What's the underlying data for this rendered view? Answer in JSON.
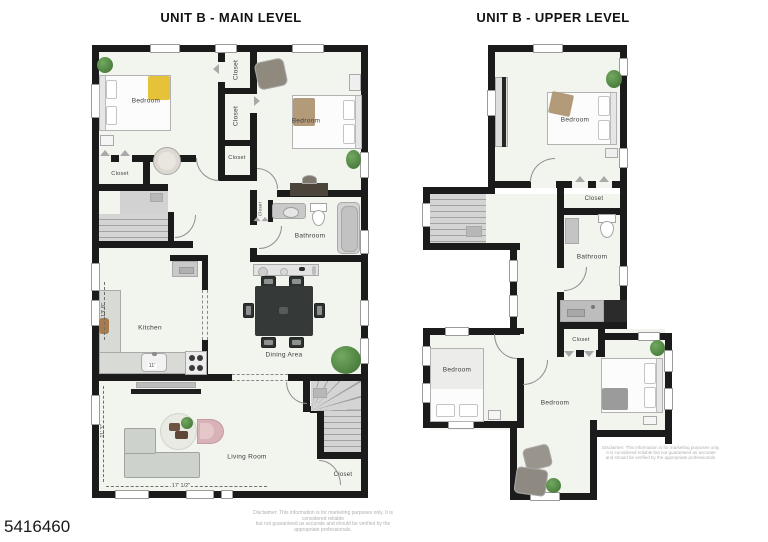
{
  "photo_id": "5416460",
  "disclaimer": {
    "line1": "Disclaimer: This information is for marketing purposes only. It is considered reliable",
    "line2": "but not guaranteed as accurate and should be verified by the appropriate professionals."
  },
  "colors": {
    "wall": "#1b1b1b",
    "floor": "#f2f5ee",
    "accent_yellow": "#e5c238",
    "accent_tan": "#b39a78",
    "plant_green": "#4c7c3e",
    "table_dark": "#35393 7",
    "sofa_gray": "#cdd2cc",
    "pink_chair": "#d8b2b6"
  },
  "main_level": {
    "title": "UNIT B - MAIN LEVEL",
    "rooms": {
      "bedroom_left": "Bedroom",
      "bedroom_right": "Bedroom",
      "closet_top": "Closet",
      "closet_mid": "Closet",
      "closet_lower": "Closet",
      "closet_hall": "Closet",
      "closet_bath": "Closet",
      "bathroom": "Bathroom",
      "kitchen": "Kitchen",
      "dining": "Dining Area",
      "living": "Living Room",
      "closet_stairs": "Closet"
    },
    "dims": {
      "kitchen_depth": "13' 8\"",
      "kitchen_counter": "11'",
      "living_depth": "11' 3\"",
      "living_width": "17' 1/2\""
    }
  },
  "upper_level": {
    "title": "UNIT B - UPPER LEVEL",
    "rooms": {
      "bedroom_top": "Bedroom",
      "closet_hall": "Closet",
      "bathroom": "Bathroom",
      "bedroom_left": "Bedroom",
      "closet_mid": "Closet",
      "bedroom_center": "Bedroom"
    }
  }
}
